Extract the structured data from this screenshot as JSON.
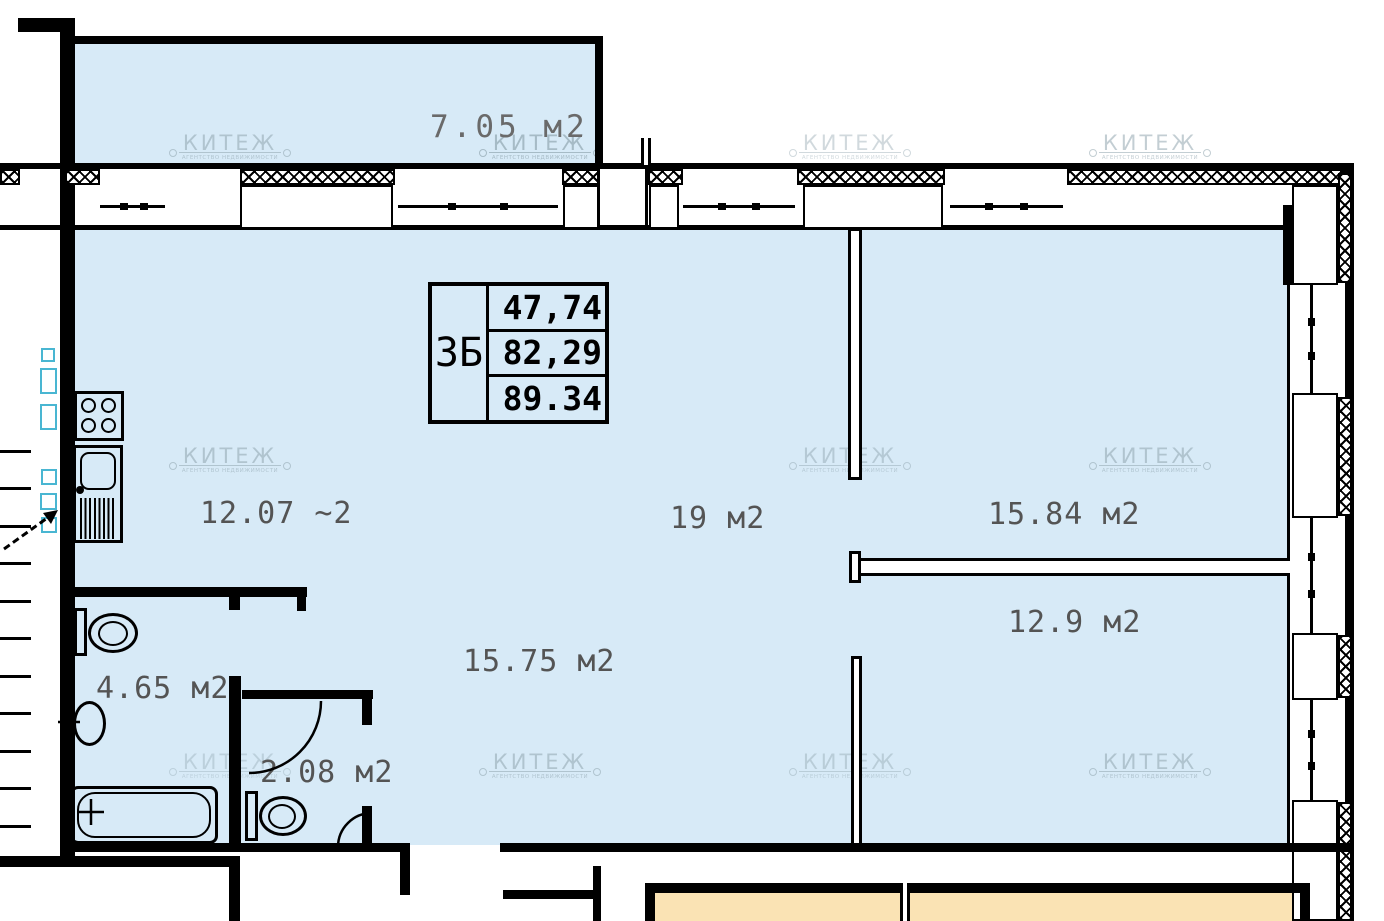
{
  "apartment": {
    "unit": "3Б",
    "values": [
      "47,74",
      "82,29",
      "89.34"
    ]
  },
  "rooms": [
    {
      "id": "balcony",
      "label": "7.05 м2"
    },
    {
      "id": "kitchen",
      "label": "12.07 ~2"
    },
    {
      "id": "room-19",
      "label": "19 м2"
    },
    {
      "id": "room-15-84",
      "label": "15.84 м2"
    },
    {
      "id": "room-12-9",
      "label": "12.9 м2"
    },
    {
      "id": "hall",
      "label": "15.75 м2"
    },
    {
      "id": "bathroom",
      "label": "4.65 м2"
    },
    {
      "id": "wc",
      "label": "2.08 м2"
    }
  ],
  "watermark": {
    "brand": "КИТЕЖ",
    "tagline": "АГЕНТСТВО НЕДВИЖИМОСТИ"
  },
  "colors": {
    "room_fill": "#d7eaf7",
    "neighbor_fill": "#fae3b4",
    "shaft_outline": "#49b6d2",
    "wall": "#000000",
    "label_text": "#545454"
  }
}
